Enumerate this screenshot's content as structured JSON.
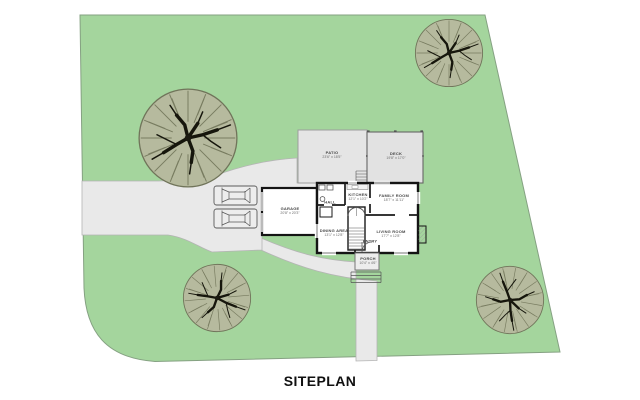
{
  "title": "SITEPLAN",
  "colors": {
    "lawn": "#a4d59d",
    "canopy": "#b6ba9e",
    "driveway": "#e9e9e9",
    "hardscape": "#e3e3e3"
  },
  "rooms": {
    "patio": {
      "name": "PATIO",
      "dims": "23'6\" x 18'5\""
    },
    "deck": {
      "name": "DECK",
      "dims": "19'8\" x 17'0\""
    },
    "garage": {
      "name": "GARAGE",
      "dims": "20'8\" x 20'3\""
    },
    "kitchen": {
      "name": "KITCHEN",
      "dims": "12'1\" x 10'2\""
    },
    "family_room": {
      "name": "FAMILY ROOM",
      "dims": "18'7\" x 11'11\""
    },
    "dining_area": {
      "name": "DINING AREA",
      "dims": "13'1\" x 12'8\""
    },
    "living_room": {
      "name": "LIVING ROOM",
      "dims": "17'7\" x 12'8\""
    },
    "hall": {
      "name": "HALL"
    },
    "entry": {
      "name": "ENTRY"
    },
    "porch": {
      "name": "PORCH",
      "dims": "10'4\" x 4'6\""
    }
  }
}
